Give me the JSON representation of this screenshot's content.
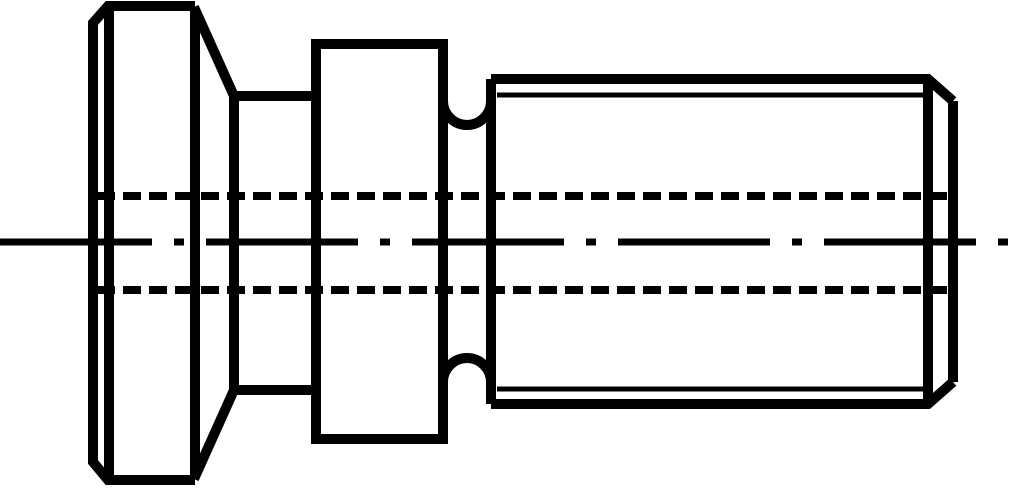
{
  "canvas": {
    "width": 1024,
    "height": 492,
    "background_color": "#ffffff",
    "stroke_color": "#000000"
  },
  "drawing": {
    "line_styles": {
      "outline": {
        "width": 10,
        "dash": ""
      },
      "thin": {
        "width": 5,
        "dash": ""
      },
      "hidden": {
        "width": 8,
        "dash": "18 8"
      },
      "center": {
        "width": 7,
        "dash": "152 22 10 22"
      }
    },
    "primitives": [
      {
        "name": "head-outline",
        "style": "outline",
        "path": "M 195,6 L 108,6 L 93,23 L 93,462 L 108,480 L 195,480"
      },
      {
        "name": "head-chamfer-edge",
        "style": "outline",
        "path": "M 109,6 L 109,480"
      },
      {
        "name": "head-right-face-edge",
        "style": "outline",
        "path": "M 195,9 L 195,477"
      },
      {
        "name": "cone-upper-silhouette",
        "style": "outline",
        "path": "M 194,7 L 234,96"
      },
      {
        "name": "cone-lower-silhouette",
        "style": "outline",
        "path": "M 194,479 L 234,390"
      },
      {
        "name": "neck-upper-silhouette",
        "style": "outline",
        "path": "M 234,96 L 318,96"
      },
      {
        "name": "neck-lower-silhouette",
        "style": "outline",
        "path": "M 234,390 L 318,390"
      },
      {
        "name": "cone-neck-edge",
        "style": "outline",
        "path": "M 234,96 L 234,390"
      },
      {
        "name": "collar-outline",
        "style": "outline",
        "path": "M 316,44 L 443,44 L 443,439 L 316,439 Z"
      },
      {
        "name": "undercut-upper-arc",
        "style": "outline",
        "path": "M 443,101 A 24 24 0 0 0 491,101"
      },
      {
        "name": "undercut-lower-arc",
        "style": "outline",
        "path": "M 443,382 A 24 24 0 0 1 491,382"
      },
      {
        "name": "undercut-thread-edge",
        "style": "outline",
        "path": "M 491,79 L 491,404"
      },
      {
        "name": "shank-upper-silhouette",
        "style": "outline",
        "path": "M 491,79 L 928,79 L 953,101"
      },
      {
        "name": "shank-lower-silhouette",
        "style": "outline",
        "path": "M 491,404 L 928,404 L 953,382"
      },
      {
        "name": "shank-chamfer-edge",
        "style": "outline",
        "path": "M 928,79 L 928,404"
      },
      {
        "name": "shank-end-face",
        "style": "outline",
        "path": "M 953,101 L 953,382"
      },
      {
        "name": "thread-root-upper",
        "style": "thin",
        "path": "M 497,95 L 928,95"
      },
      {
        "name": "thread-root-lower",
        "style": "thin",
        "path": "M 497,389 L 928,389"
      },
      {
        "name": "hidden-bore-upper",
        "style": "hidden",
        "path": "M 97,196 L 951,196"
      },
      {
        "name": "hidden-bore-lower",
        "style": "hidden",
        "path": "M 97,290 L 951,290"
      },
      {
        "name": "centerline",
        "style": "center",
        "path": "M 0,242 L 1012,242"
      }
    ]
  }
}
